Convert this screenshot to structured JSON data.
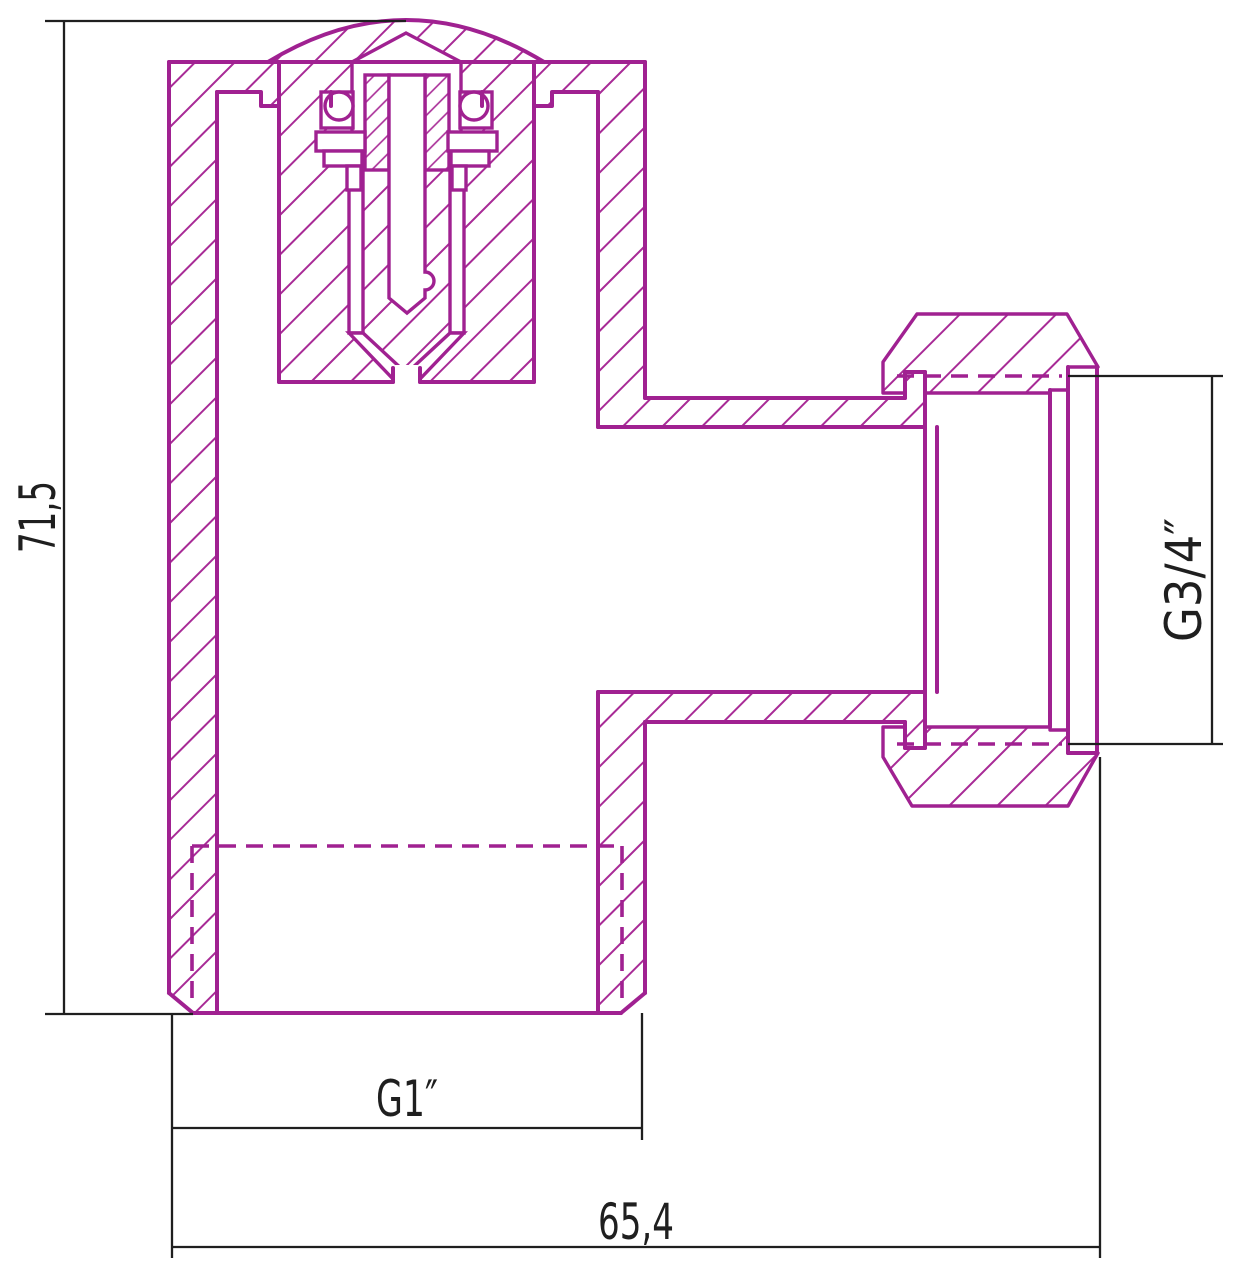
{
  "drawing": {
    "title": "valve-fitting-cross-section",
    "dimensions": {
      "height": "71,5",
      "outlet_thread": "G3/4″",
      "bottom_thread": "G1″",
      "width": "65,4"
    },
    "colors": {
      "outline": "#a02191",
      "hatch": "#a82b96",
      "dim_line": "#1f1f1f",
      "background": "#ffffff"
    }
  }
}
